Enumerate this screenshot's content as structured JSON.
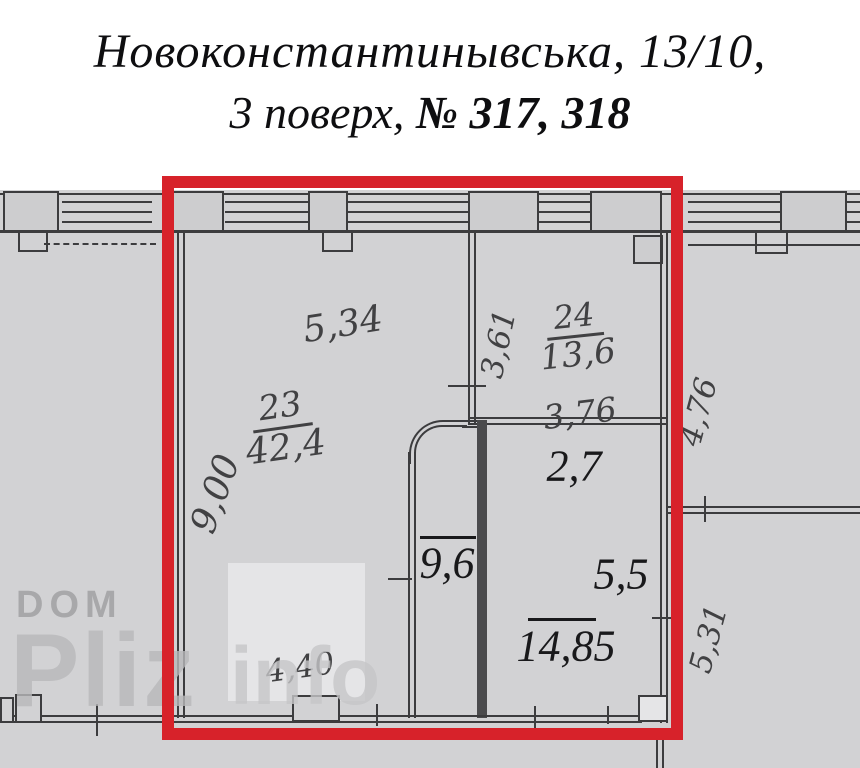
{
  "title": {
    "line1": "Новоконстантинывська, 13/10,",
    "line2_floor": "3 поверх,",
    "line2_numbers": "№ 317, 318"
  },
  "labels": {
    "dim_534": "5,34",
    "room24_number": "24",
    "room24_area": "13,6",
    "dim_361": "3,61",
    "room23_number": "23",
    "room23_area": "42,4",
    "dim_376": "3,76",
    "dim_900": "9,00",
    "area_27": "2,7",
    "area_96": "9,6",
    "area_55": "5,5",
    "area_1485": "14,85",
    "dim_440": "4,40",
    "dim_476": "4,76",
    "dim_531": "5,31"
  },
  "watermarks": {
    "dom": "DOM",
    "pliz": "Pliz",
    "info": "info"
  },
  "colors": {
    "paper": "#d2d2d4",
    "wall": "#3c3c3e",
    "thick_wall": "#4b4b4d",
    "highlight_red": "#d7222a",
    "handwriting": "#414143",
    "typed": "#19191b",
    "watermark": "#9a9a9c",
    "watermark_light": "#c6c6c8",
    "light_patch": "#e5e5e7",
    "pillar": "#cdcdcf"
  }
}
